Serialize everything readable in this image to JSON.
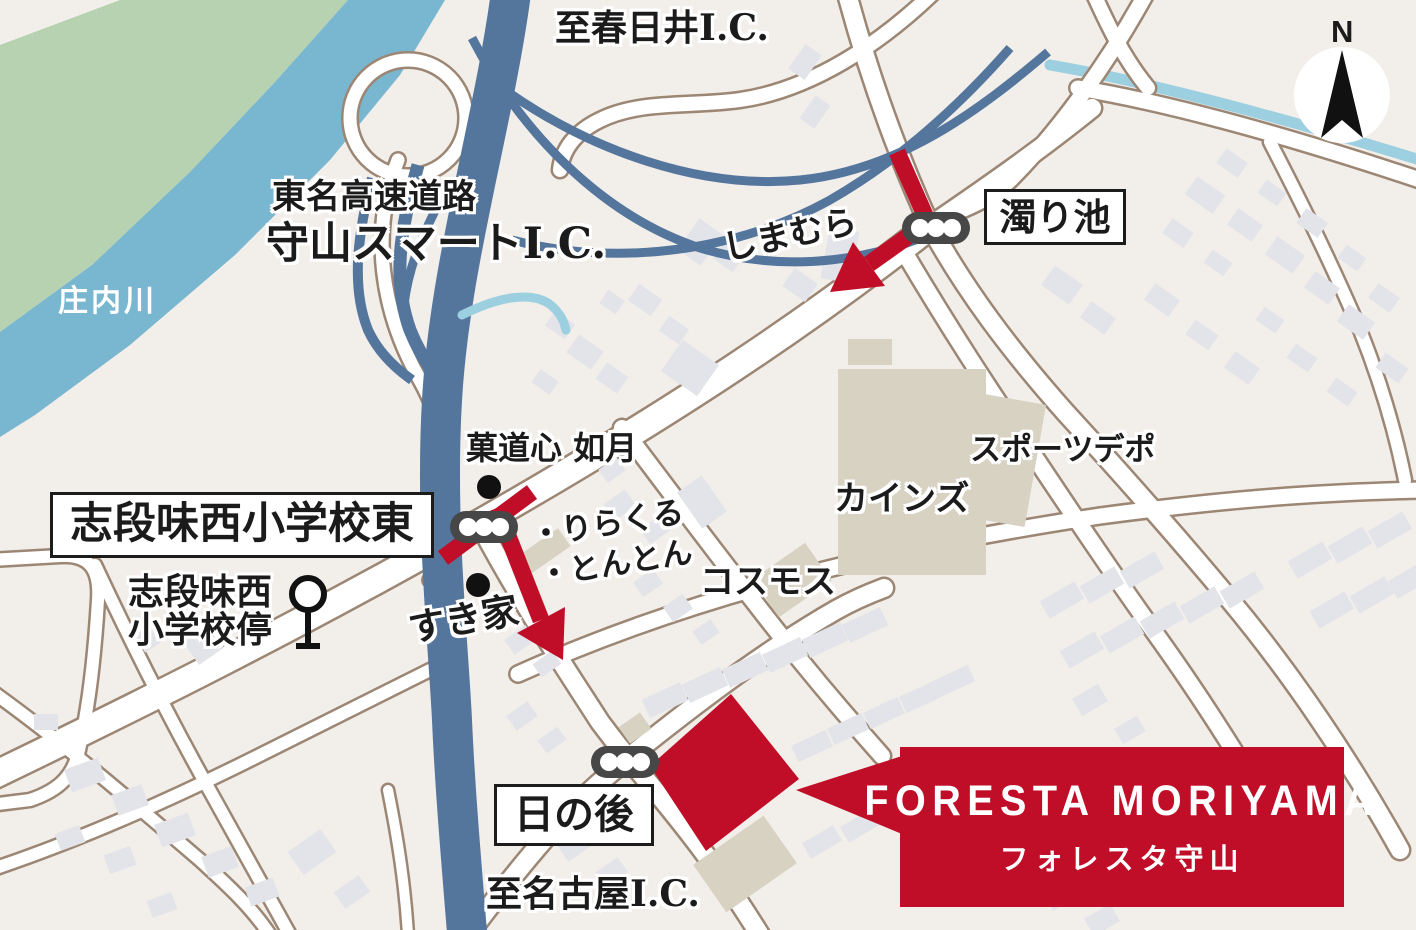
{
  "title": "FORESTA MORIYAMA access map",
  "colors": {
    "background": "#f2eeea",
    "road_fill": "#ffffff",
    "road_casing": "#9c8674",
    "building_gray": "#e3e4e9",
    "building_tan": "#d8d2c3",
    "river_water": "#79b7d0",
    "greenbelt": "#b7d2b1",
    "expressway_blue": "#54769d",
    "stream_blue": "#9ccfe0",
    "route_red": "#c10e28",
    "traffic_light_body": "#474747",
    "label_ink": "#1b1b1b",
    "label_box_bg": "#ffffff"
  },
  "labels": {
    "to_kasugai_ic": "至春日井I.C.",
    "expressway_name": "東名高速道路",
    "smart_ic": "守山スマートI.C.",
    "shonai_river": "庄内川",
    "nigori_ike": "濁り池",
    "shimamura": "しまむら",
    "kadoshin_kisaragi": "菓道心 如月",
    "shidami_nishi_school_east": "志段味西小学校東",
    "bus_stop_line1": "志段味西",
    "bus_stop_line2": "小学校停",
    "rirakuru": "・りらくる",
    "tonton": "・とんとん",
    "sukiya": "すき家",
    "cosmos": "コスモス",
    "cainz": "カインズ",
    "sports_depo": "スポーツデポ",
    "hinoato": "日の後",
    "to_nagoya_ic": "至名古屋I.C.",
    "north": "N"
  },
  "destination": {
    "name_en": "FORESTA MORIYAMA",
    "name_jp": "フォレスタ守山"
  },
  "icons": {
    "north_arrow": "north-arrow-icon",
    "traffic_light": "traffic-light-icon",
    "bus_stop": "bus-stop-icon",
    "poi_dot": "poi-dot-icon",
    "route_arrow": "route-arrow-icon",
    "destination_marker": "destination-marker"
  }
}
